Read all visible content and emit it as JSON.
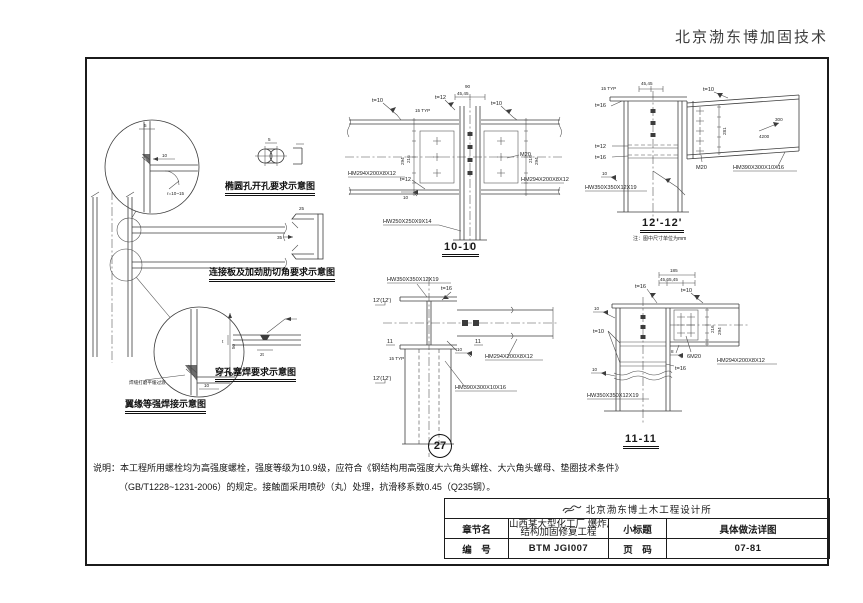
{
  "brand": "北京渤东博加固技术",
  "left_detail": {
    "caption": "翼缘等强焊接示意图",
    "c1_t": "5",
    "c1_dim": "10",
    "c1_r": "r=10~15",
    "c2_dim_h": "50",
    "c2_dim_w": "10",
    "c2_note": "焊缝打磨平缓过渡"
  },
  "schematics": {
    "oval_caption": "椭圆孔开孔要求示意图",
    "oval_dim": "5",
    "plate_caption": "连接板及加劲肋切角要求示意图",
    "plate_dim_a": "35",
    "plate_dim_b": "25",
    "plug_caption": "穿孔塞焊要求示意图",
    "plug_dim_a": "2t",
    "plug_dim_b": "t"
  },
  "s1010": {
    "title": "10-10",
    "beam_left": "HM294X200X8X12",
    "beam_right": "HM294X200X8X12",
    "column": "HW250X250X9X14",
    "bolt": "M20",
    "t10a": "t=10",
    "t12a": "t=12",
    "t10b": "t=10",
    "t12b": "t=12",
    "w10": "10",
    "typ": "15 TYP",
    "dim90": "90",
    "dim4545": "45,45",
    "dim294l": "294",
    "dim216l": "216",
    "dim294r": "294",
    "dim216r": "216"
  },
  "s1212": {
    "title": "12'-12'",
    "note": "注：图中尺寸单位为mm",
    "t16a": "t=16",
    "t12": "t=12",
    "t16b": "t=16",
    "t10": "t=10",
    "w10": "10",
    "typ": "15 TYP",
    "dim4545": "45,45",
    "dim281": "281",
    "slope_rise": "300",
    "slope_run": "4200",
    "bolt": "M20",
    "beam": "HM390X300X10X16",
    "column": "HW350X350X12X19"
  },
  "plan27": {
    "bubble": "27",
    "column": "HW350X350X12X19",
    "beam_right": "HM294X200X8X12",
    "beam_down": "HM390X300X10X16",
    "t16": "t=16",
    "w10": "10",
    "typ": "15 TYP",
    "sec12a": "12'(12')",
    "sec12b": "12'(12')",
    "sec11a": "11",
    "sec11b": "11"
  },
  "s1111": {
    "title": "11-11",
    "dim185": "185",
    "dim_sub": "45,65,45",
    "t16a": "t=16",
    "t10a": "t=10",
    "t10b": "t=10",
    "t16b": "t=16",
    "w10a": "10",
    "w8": "8",
    "w10b": "10",
    "bolt": "6M20",
    "beam": "HM294X200X8X12",
    "column": "HW350X350X12X19",
    "dim216": "216",
    "dim294": "294"
  },
  "notes": {
    "line1": "说明：本工程所用螺栓均为高强度螺栓，强度等级为10.9级，应符合《钢结构用高强度大六角头螺栓、大六角头螺母、垫圈技术条件》",
    "line2": "（GB/T1228~1231-2006）的规定。接触面采用喷砂（丸）处理，抗滑移系数0.45（Q235钢）。"
  },
  "titleblock": {
    "firm": "北京渤东博土木工程设计所",
    "chapter_label": "章节名",
    "chapter_value_1": "山西某大型化工厂 爆炸后",
    "chapter_value_2": "结构加固修复工程",
    "subtitle_label": "小标题",
    "subtitle_value": "具体做法详图",
    "number_label": "编　号",
    "number_value": "BTM JGI007",
    "page_label": "页　码",
    "page_value": "07-81"
  }
}
